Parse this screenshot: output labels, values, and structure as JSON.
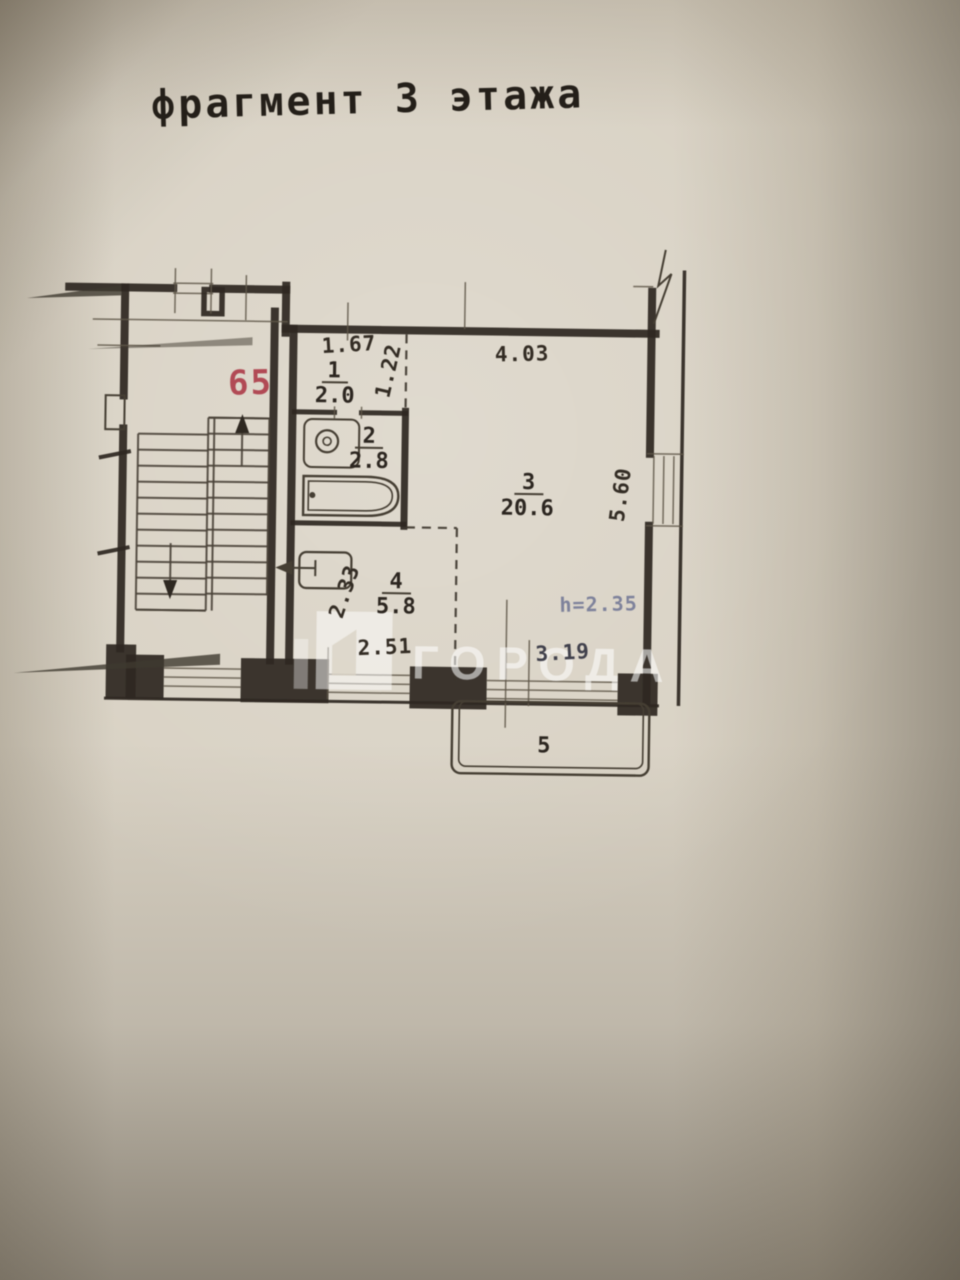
{
  "document": {
    "title": "фрагмент 3 этажа",
    "apartment_number": "65"
  },
  "rooms": {
    "hall": {
      "num": "1",
      "area": "2.0"
    },
    "bathroom": {
      "num": "2",
      "area": "2.8"
    },
    "living": {
      "num": "3",
      "area": "20.6"
    },
    "kitchen": {
      "num": "4",
      "area": "5.8"
    },
    "balcony": {
      "num": "5"
    }
  },
  "dimensions": {
    "hall_width": "1.67",
    "hall_depth": "1.22",
    "living_width": "4.03",
    "living_depth": "5.60",
    "kitchen_depth": "2.33",
    "kitchen_width": "2.51",
    "living_bottom_width": "3.19",
    "ceiling_height": "h=2.35"
  },
  "watermark": {
    "text": "ГОРОДА"
  },
  "colors": {
    "paper": "#d8d1c3",
    "ink": "#2e2821",
    "apartment_red": "#b14a55",
    "height_blue": "#7e829b",
    "watermark_white": "#ffffff"
  }
}
